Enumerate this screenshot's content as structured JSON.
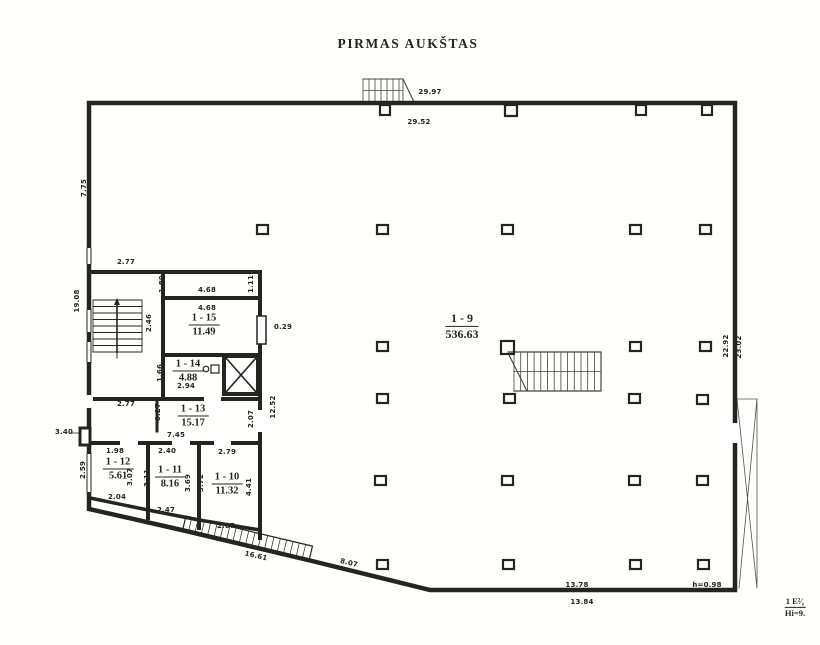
{
  "title": "PIRMAS AUKŠTAS",
  "rooms": [
    {
      "number": "1 - 9",
      "area": "536.63"
    },
    {
      "number": "1 - 15",
      "area": "11.49"
    },
    {
      "number": "1 - 14",
      "area": "4.88"
    },
    {
      "number": "1 - 13",
      "area": "15.17"
    },
    {
      "number": "1 - 12",
      "area": "5.61"
    },
    {
      "number": "1 - 11",
      "area": "8.16"
    },
    {
      "number": "1 - 10",
      "area": "11.32"
    }
  ],
  "dimensions": [
    {
      "t": "29.97"
    },
    {
      "t": "29.52"
    },
    {
      "t": "7.75"
    },
    {
      "t": "19.08"
    },
    {
      "t": "2.77"
    },
    {
      "t": "1.89"
    },
    {
      "t": "4.68"
    },
    {
      "t": "1.11"
    },
    {
      "t": "4.68"
    },
    {
      "t": "2.46"
    },
    {
      "t": "0.29"
    },
    {
      "t": "1.66"
    },
    {
      "t": "2.94"
    },
    {
      "t": "2.77"
    },
    {
      "t": "0.27"
    },
    {
      "t": "12.52"
    },
    {
      "t": "2.07"
    },
    {
      "t": "7.45"
    },
    {
      "t": "3.40"
    },
    {
      "t": "1.98"
    },
    {
      "t": "2.40"
    },
    {
      "t": "2.79"
    },
    {
      "t": "2.59"
    },
    {
      "t": "3.07"
    },
    {
      "t": "3.11"
    },
    {
      "t": "3.69"
    },
    {
      "t": "3.72"
    },
    {
      "t": "4.41"
    },
    {
      "t": "2.04"
    },
    {
      "t": "2.47"
    },
    {
      "t": "2.87"
    },
    {
      "t": "16.61"
    },
    {
      "t": "8.07"
    },
    {
      "t": "22.92"
    },
    {
      "t": "23.02"
    },
    {
      "t": "13.78"
    },
    {
      "t": "13.84"
    },
    {
      "t": "h=0.98"
    }
  ],
  "corner_mark": {
    "line1": "1 E²⁄₁",
    "line2": "Hi=9."
  },
  "colors": {
    "ink": "#26241f",
    "paper": "#fffffe"
  }
}
